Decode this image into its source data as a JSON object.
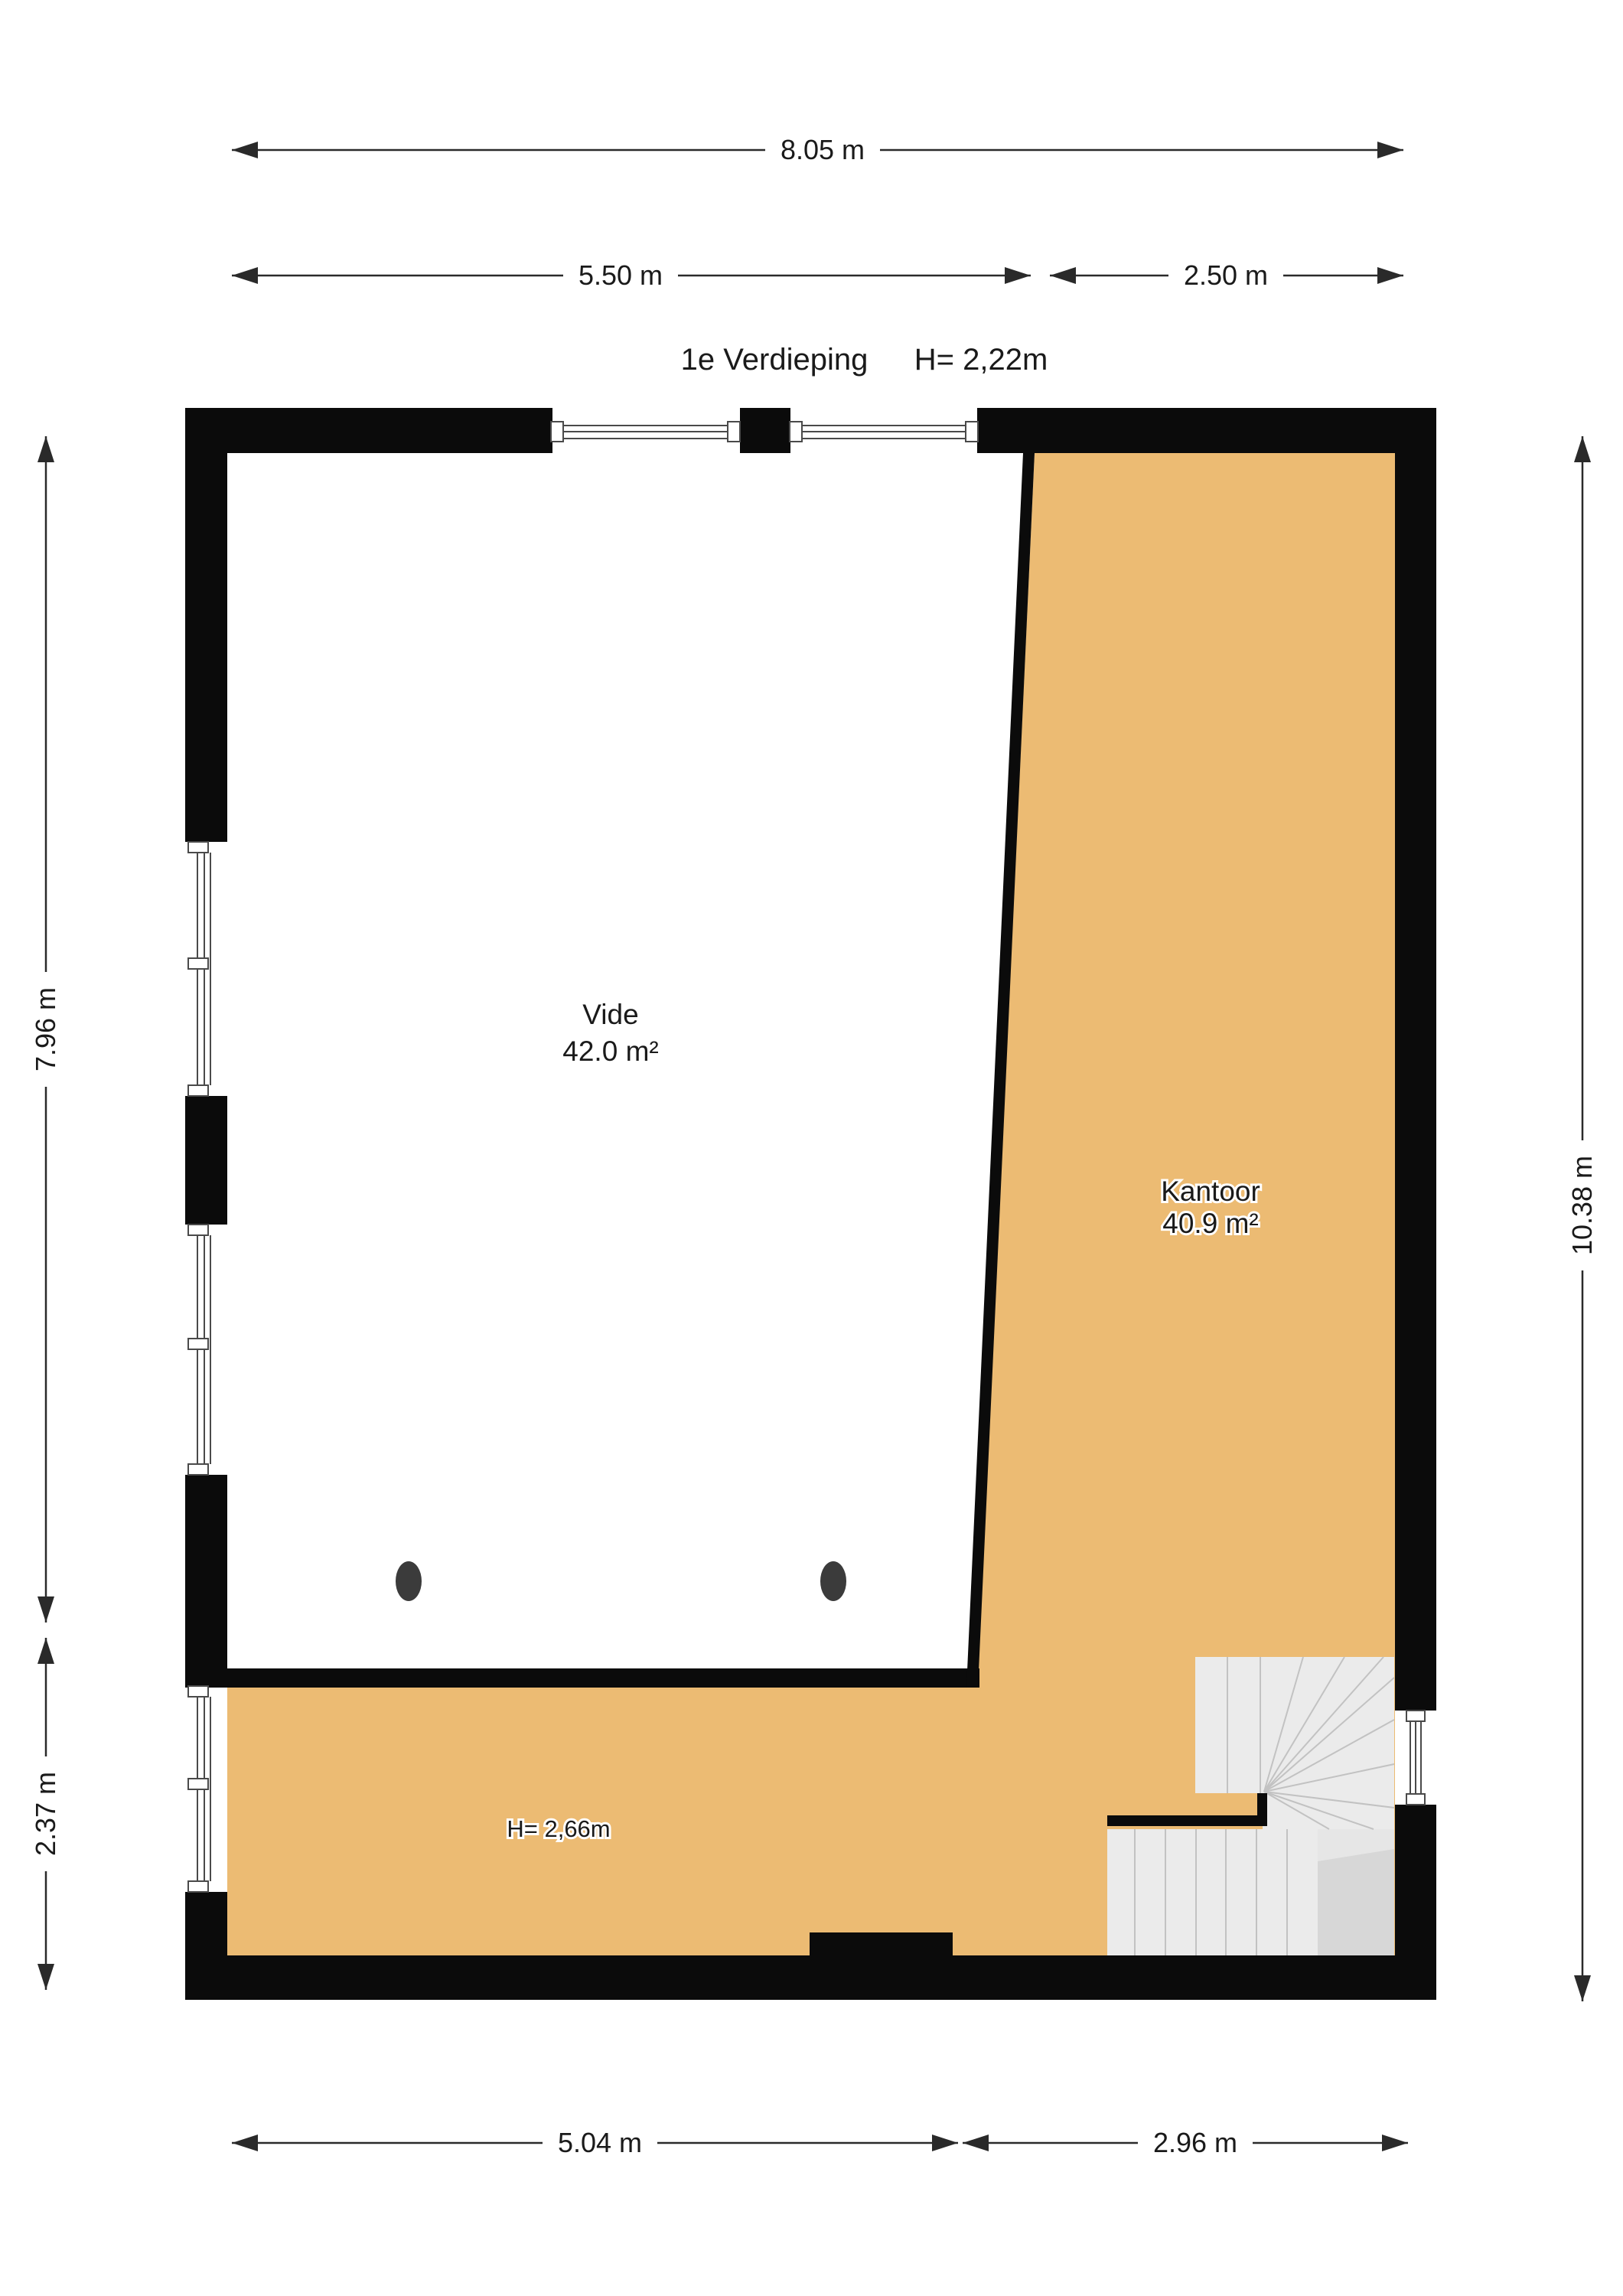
{
  "title": {
    "floor": "1e Verdieping",
    "ceiling_height": "H= 2,22m"
  },
  "rooms": [
    {
      "name": "Vide",
      "area": "42.0 m²"
    },
    {
      "name": "Kantoor",
      "area": "40.9 m²"
    }
  ],
  "annotations": {
    "strip_height": "H= 2,66m"
  },
  "dimensions": {
    "top_total": "8.05 m",
    "top_left": "5.50 m",
    "top_right": "2.50 m",
    "left_upper": "7.96 m",
    "left_lower": "2.37 m",
    "right_total": "10.38 m",
    "bottom_left": "5.04 m",
    "bottom_right": "2.96 m"
  },
  "colors": {
    "wall": "#0b0b0b",
    "room_fill": "#ecbb73",
    "stair_light": "#ebebeb",
    "stair_mid": "#e6e6e6",
    "stair_dark": "#d7d7d7",
    "stair_line": "#c2c2c2",
    "window_line": "#4a4a4a",
    "dim": "#2a2a2a",
    "text": "#1a1a1a",
    "dot": "#3b3b3b",
    "halo": "#ffffff"
  }
}
